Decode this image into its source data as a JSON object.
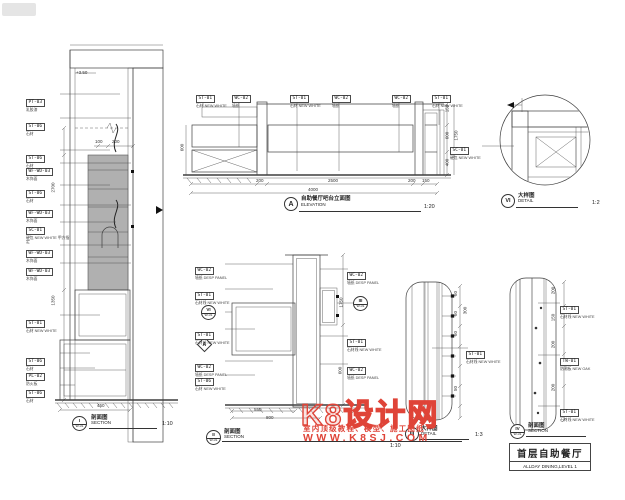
{
  "page": {
    "background": "#ffffff",
    "ink": "#3f3f3f",
    "red": "#df4438"
  },
  "watermark": {
    "brand": "K8设计网",
    "tagline": "室内顶级教程、模型、施工图纸",
    "url": "WWW.K8SJ.COM"
  },
  "title_block": {
    "cn": "首层自助餐厅",
    "en": "ALLDAY DINING,LEVEL 1"
  },
  "left_section": {
    "level": "+3.50",
    "tags": [
      {
        "code": "PT-03",
        "note": "乳胶漆"
      },
      {
        "code": "ST-06",
        "note": "石材"
      },
      {
        "code": "ST-06",
        "note": "石材"
      },
      {
        "code": "WF-WD-03",
        "note": "木饰面"
      },
      {
        "code": "ST-06",
        "note": "石材"
      },
      {
        "code": "WF-WD-03",
        "note": "木饰面"
      },
      {
        "code": "SC-01",
        "note": "硬包 NEW WHITE 甲方指定"
      },
      {
        "code": "WF-WD-03",
        "note": "木饰面"
      },
      {
        "code": "WF-WD-03",
        "note": "木饰面"
      },
      {
        "code": "ST-01",
        "note": "石材 NEW WHITE"
      },
      {
        "code": "ST-06",
        "note": "石材"
      },
      {
        "code": "PL-02",
        "note": "防火板"
      },
      {
        "code": "ST-06",
        "note": "石材"
      }
    ],
    "dims": {
      "v_upper": "2700",
      "v_lower": "1350",
      "h_left": "100",
      "h_right": "200",
      "bottom": "450"
    },
    "label": {
      "id": "I",
      "sub": "W-01",
      "cn": "剖面图",
      "en": "SECTION",
      "scale": "1:10"
    }
  },
  "elevation": {
    "tags": [
      {
        "code": "ST-01",
        "note": "石材 NEW WHITE"
      },
      {
        "code": "WC-02",
        "note": "墙纸"
      },
      {
        "code": "ST-01",
        "note": "石材 NEW WHITE"
      },
      {
        "code": "WC-02",
        "note": "墙纸"
      },
      {
        "code": "WC-02",
        "note": "墙纸"
      },
      {
        "code": "ST-01",
        "note": "石材 NEW WHITE"
      }
    ],
    "dims_bottom": [
      "200",
      "2500",
      "200",
      "150"
    ],
    "dim_total": "4000",
    "dims_right": [
      "150",
      "600",
      "400"
    ],
    "dim_right_total": "1750",
    "dim_left": "600",
    "label": {
      "id": "A",
      "cn": "自助餐厅吧台立面图",
      "en": "ELEVATION",
      "scale": "1:20"
    }
  },
  "detail_vi": {
    "tag": {
      "code": "SC-01",
      "note": "硬包 NEW WHITE"
    },
    "label": {
      "id": "VI",
      "cn": "大样图",
      "en": "DETAIL",
      "scale": "1:2"
    }
  },
  "section_ii": {
    "tags_left": [
      {
        "code": "WC-02",
        "note": "墙纸 DESP PANEL"
      },
      {
        "code": "ST-01",
        "note": "石材线 NEW WHITE"
      },
      {
        "code": "ST-01",
        "note": "石材线 NEW WHITE"
      },
      {
        "code": "WC-02",
        "note": "墙纸 DESP PANEL"
      },
      {
        "code": "ST-06",
        "note": "石材 NEW WHITE"
      }
    ],
    "tags_right": [
      {
        "code": "WC-02",
        "note": "墙纸 DESP PANEL"
      },
      {
        "code": "ST-01",
        "note": "石材线 NEW WHITE"
      },
      {
        "code": "WC-02",
        "note": "墙纸 DESP PANEL"
      }
    ],
    "ref_left": {
      "id": "VI",
      "sub": "W-01"
    },
    "ref_right": {
      "id": "III",
      "sub": "W-01"
    },
    "ref_diamond": "A",
    "dims_bottom": [
      "550",
      "800"
    ],
    "dims_right": [
      "1750",
      "600"
    ],
    "label": {
      "id": "II",
      "sub": "W-01",
      "cn": "剖面图",
      "en": "SECTION",
      "scale": "1:10"
    }
  },
  "detail_iii": {
    "tag": {
      "code": "ST-01",
      "note": "石材线 NEW WHITE"
    },
    "dims": [
      "50",
      "50",
      "50",
      "50"
    ],
    "dim_total": "300",
    "label": {
      "id": "III",
      "cn": "大样图",
      "en": "DETAIL",
      "scale": "1:3"
    }
  },
  "section_v": {
    "tags": [
      {
        "code": "ST-01",
        "note": "石材线 NEW WHITE"
      },
      {
        "code": "TW-01",
        "note": "防潮板 NEW OAK"
      },
      {
        "code": "ST-01",
        "note": "石材线 NEW WHITE"
      }
    ],
    "dims": [
      "200",
      "150",
      "200",
      "200"
    ],
    "label": {
      "id": "IV",
      "sub": "W-01",
      "cn": "剖面图",
      "en": "SECTION"
    }
  }
}
